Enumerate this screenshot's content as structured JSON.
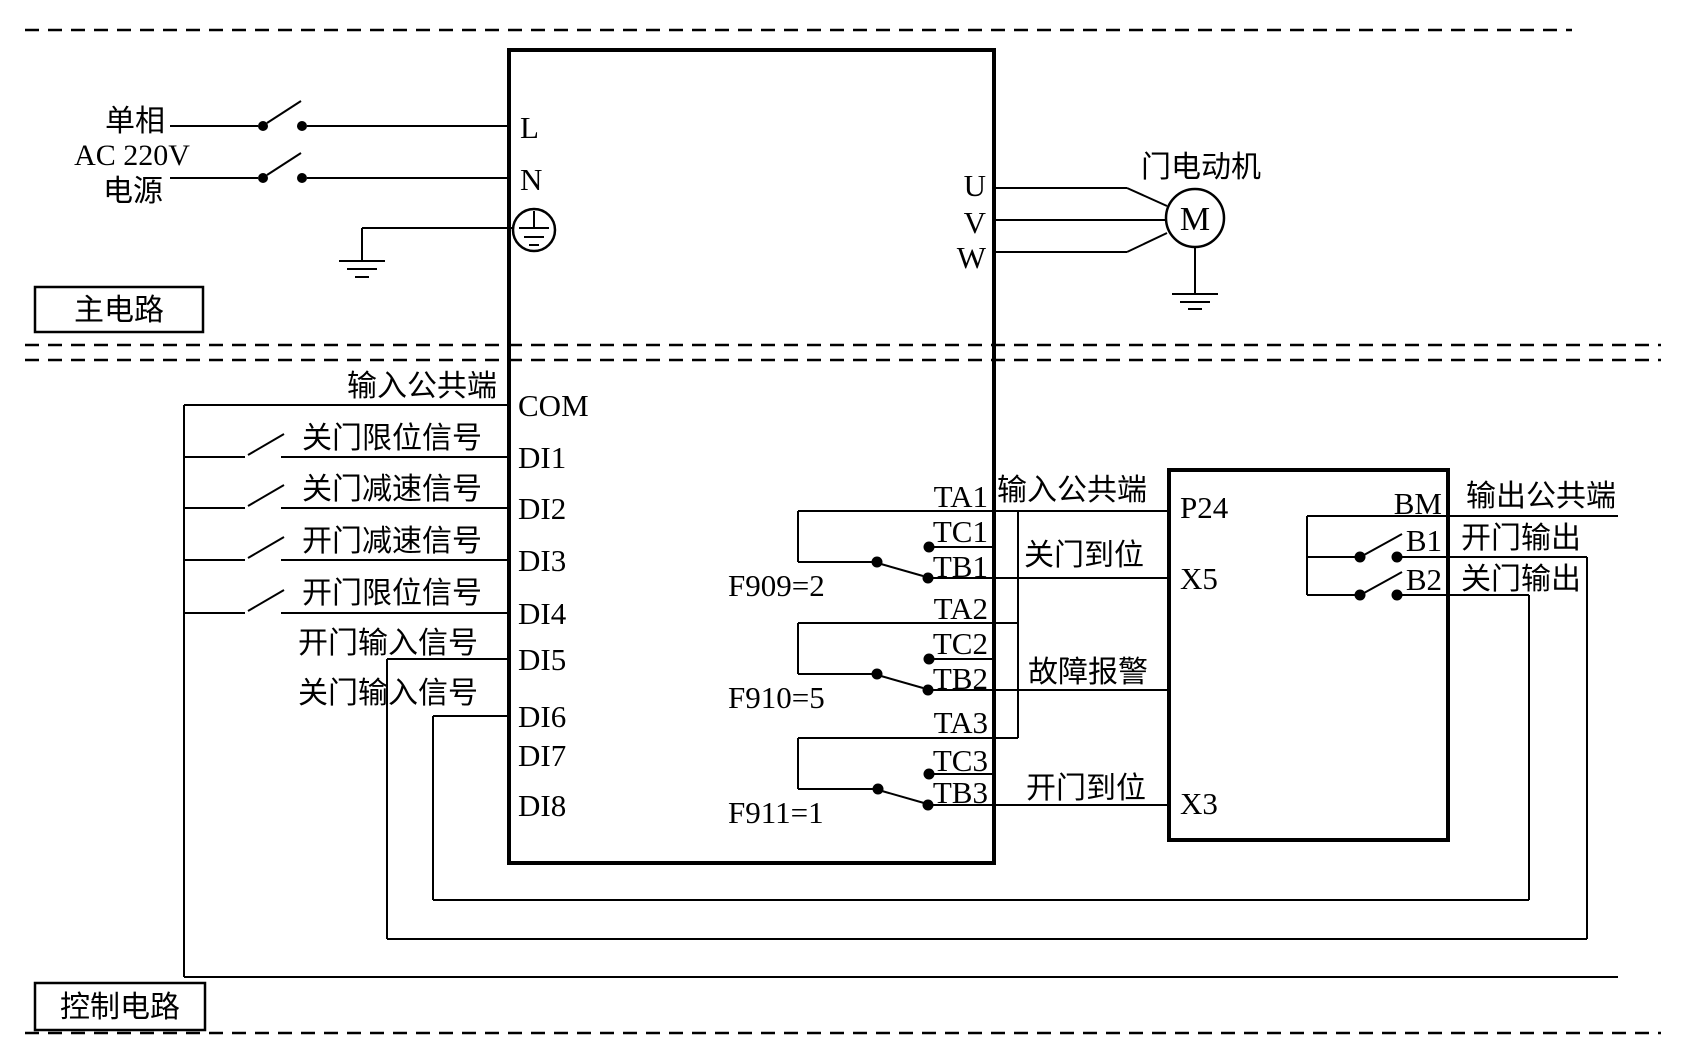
{
  "sections": {
    "main": "主电路",
    "control": "控制电路"
  },
  "power": {
    "line1": "单相",
    "line2": "AC 220V",
    "line3": "电源"
  },
  "inverter": {
    "terminals": {
      "L": "L",
      "N": "N",
      "COM": "COM",
      "DI1": "DI1",
      "DI2": "DI2",
      "DI3": "DI3",
      "DI4": "DI4",
      "DI5": "DI5",
      "DI6": "DI6",
      "DI7": "DI7",
      "DI8": "DI8",
      "U": "U",
      "V": "V",
      "W": "W",
      "TA1": "TA1",
      "TC1": "TC1",
      "TB1": "TB1",
      "TA2": "TA2",
      "TC2": "TC2",
      "TB2": "TB2",
      "TA3": "TA3",
      "TC3": "TC3",
      "TB3": "TB3"
    },
    "params": {
      "relay1": "F909=2",
      "relay2": "F910=5",
      "relay3": "F911=1"
    }
  },
  "motor": {
    "label": "门电动机",
    "symbol": "M"
  },
  "controller": {
    "terminals": {
      "P24": "P24",
      "X5": "X5",
      "X3": "X3",
      "BM": "BM",
      "B1": "B1",
      "B2": "B2"
    }
  },
  "signals": {
    "input_common": "输入公共端",
    "close_limit": "关门限位信号",
    "close_decel": "关门减速信号",
    "open_decel": "开门减速信号",
    "open_limit": "开门限位信号",
    "open_input": "开门输入信号",
    "close_input": "关门输入信号",
    "close_done": "关门到位",
    "fault_alarm": "故障报警",
    "open_done": "开门到位",
    "output_common": "输出公共端",
    "open_output": "开门输出",
    "close_output": "关门输出"
  },
  "colors": {
    "line": "#000000",
    "background": "#ffffff"
  }
}
